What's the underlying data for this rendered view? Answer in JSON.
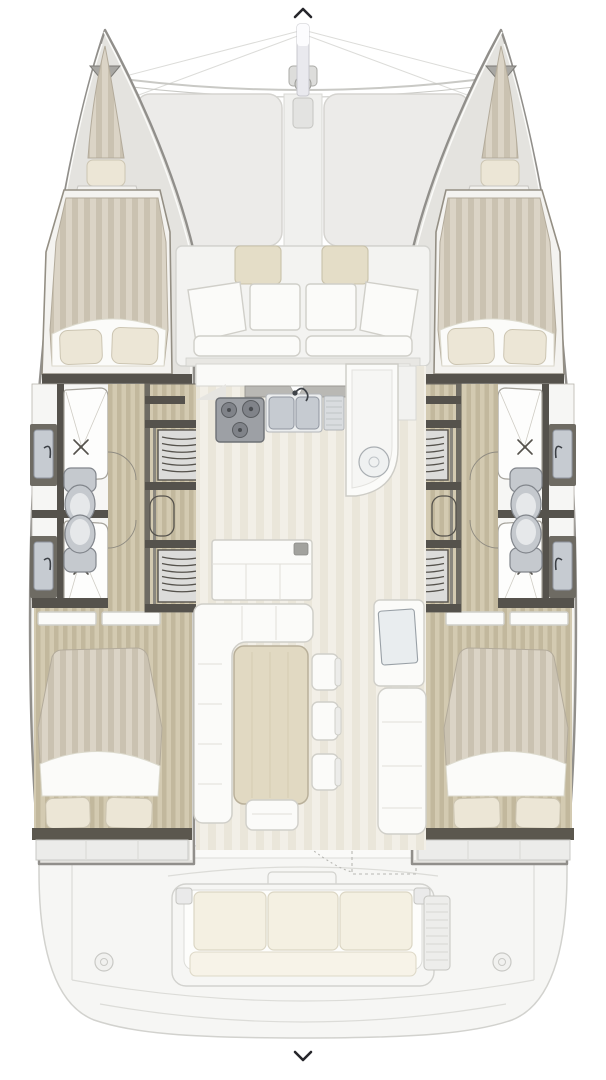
{
  "palette": {
    "background": "#ffffff",
    "hull_edge": "#918f8b",
    "hull_deck": "#e4e3df",
    "hull_highlight": "#fbfbf9",
    "wall_dark": "#55524c",
    "wall_brown": "#6e6b63",
    "wood_light": "#d3cab1",
    "wood_dark": "#c2b89d",
    "matt_light": "#dbd4c6",
    "matt_dark": "#cac2b1",
    "matt_edge": "#b3ab9b",
    "floor_light": "#f2efe7",
    "floor_dark": "#eae6da",
    "pillow": "#ece6d6",
    "pillow_edge": "#ccc5b2",
    "cushion": "#e4ddc7",
    "cushion_edge": "#c8c1aa",
    "white_surface": "#fbfbf9",
    "line_gray": "#d0cfc9",
    "blanket_edge": "#dcdacd",
    "steel": "#c6cbd1",
    "steel_dark": "#9096a0",
    "fixture_fill": "#c5c9ce",
    "fixture_light": "#e6e8ea",
    "fixture_edge": "#82868c",
    "stove": "#9da0a5",
    "stove_edge": "#6d7075",
    "burner": "#808389",
    "burner_edge": "#595c60",
    "trampoline": "#ecebe9",
    "tramp_edge": "#d5d4d0",
    "rig_line": "#dcdcd9",
    "beam_line": "#c9c9c5",
    "table_wood": "#e1d9c2",
    "table_edge": "#b9b09a",
    "table_grain": "#d4cbb2",
    "seat_line": "#e0dfd9",
    "aft_fill": "#f6f6f4",
    "aft_line": "#d2d2ce",
    "faint_line": "#dcdcd8",
    "aft_cushion": "#f4f0e2",
    "aft_cushion_edge": "#dbd6c4",
    "track_gray": "#b9b8b4",
    "track_edge": "#97968f",
    "stair_fill": "#dcdcda",
    "shower_fill": "#fdfdfc",
    "shower_edge": "#a5a29a",
    "shower_fold": "#cfccc4",
    "door_arc": "#8f8b81",
    "chevron": "#26262b",
    "mast_fill": "#e9e9ee",
    "mast_edge": "#c8c8ce"
  },
  "carousel": {
    "prev_icon": "chevron-up",
    "next_icon": "chevron-down"
  },
  "floorplan": {
    "type": "catamaran-deck-plan-top-view",
    "hull_count": 2,
    "symmetry": "port-starboard-mirrored",
    "areas": [
      "bow-trampoline",
      "mast-and-rigging",
      "anchor-roller",
      "forward-cockpit-seating",
      "saloon-windshield",
      "galley-stove-and-double-sink",
      "galley-peninsula-round-sink",
      "saloon-dinette-l-sofa-table-chairs",
      "chart-table-with-settee",
      "port-forward-cabin-double-berth",
      "port-bathrooms-two-shower-two-toilet",
      "port-companionway-steps",
      "port-aft-cabin-double-berth",
      "starboard-forward-cabin-double-berth",
      "starboard-bathrooms-two-shower-two-toilet",
      "starboard-companionway-steps",
      "starboard-aft-cabin-double-berth",
      "aft-cockpit-bench-three-cushions",
      "transom-platform"
    ]
  }
}
